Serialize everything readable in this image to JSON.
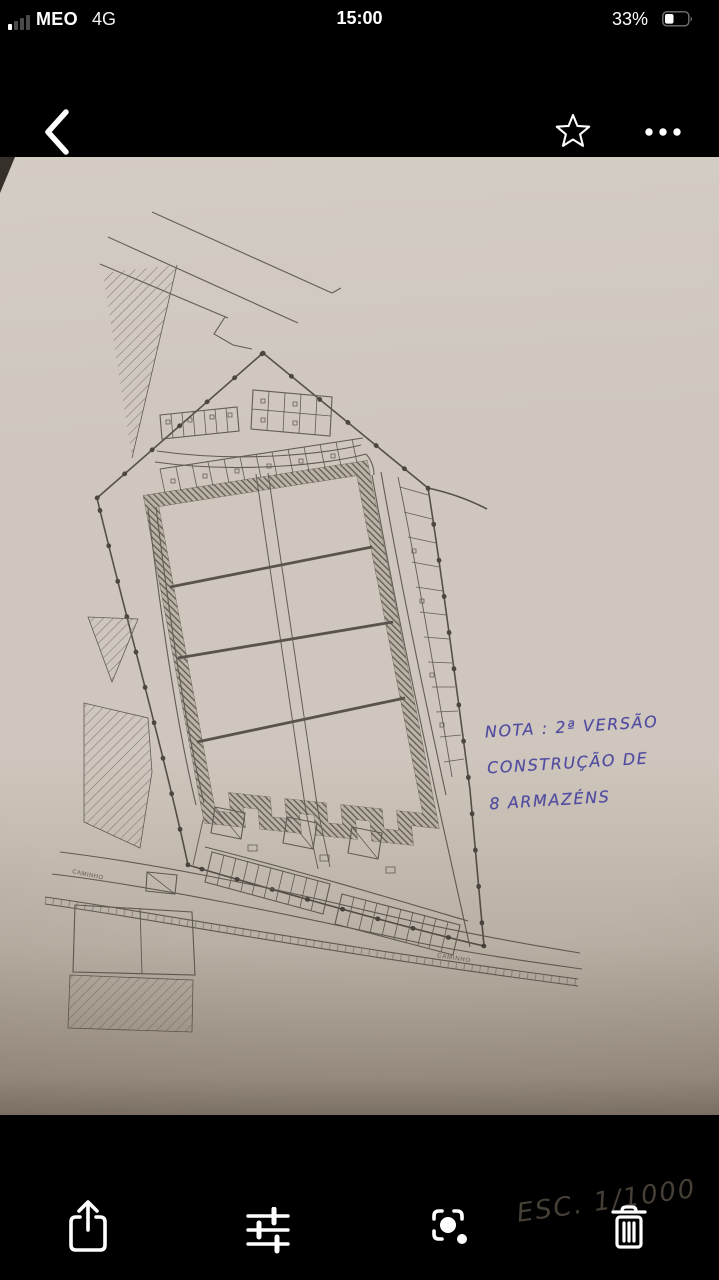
{
  "status_bar": {
    "carrier": "MEO",
    "network": "4G",
    "time": "15:00",
    "battery": "33%"
  },
  "nav_bar": {
    "back_icon": "chevron-left",
    "favorite_icon": "star-outline",
    "more_icon": "ellipsis"
  },
  "photo": {
    "kind": "photographed site-plan drawing",
    "annotation": {
      "line1": "NOTA : 2ª VERSÃO",
      "line2": "CONSTRUÇÃO DE",
      "line3": "8 ARMAZÉNS"
    },
    "scale_note": "ESC. 1/1000",
    "road_labels": {
      "left": "CAMINHO",
      "right": "CAMINHO"
    }
  },
  "toolbar": {
    "icons": [
      "share",
      "adjust",
      "visual-lookup",
      "trash"
    ]
  },
  "colors": {
    "chrome": "#000000",
    "paper": "#cfc7bd",
    "ink_blue": "#413c9b",
    "ink_dark": "#4e463c",
    "plan_line": "#4b453f"
  }
}
